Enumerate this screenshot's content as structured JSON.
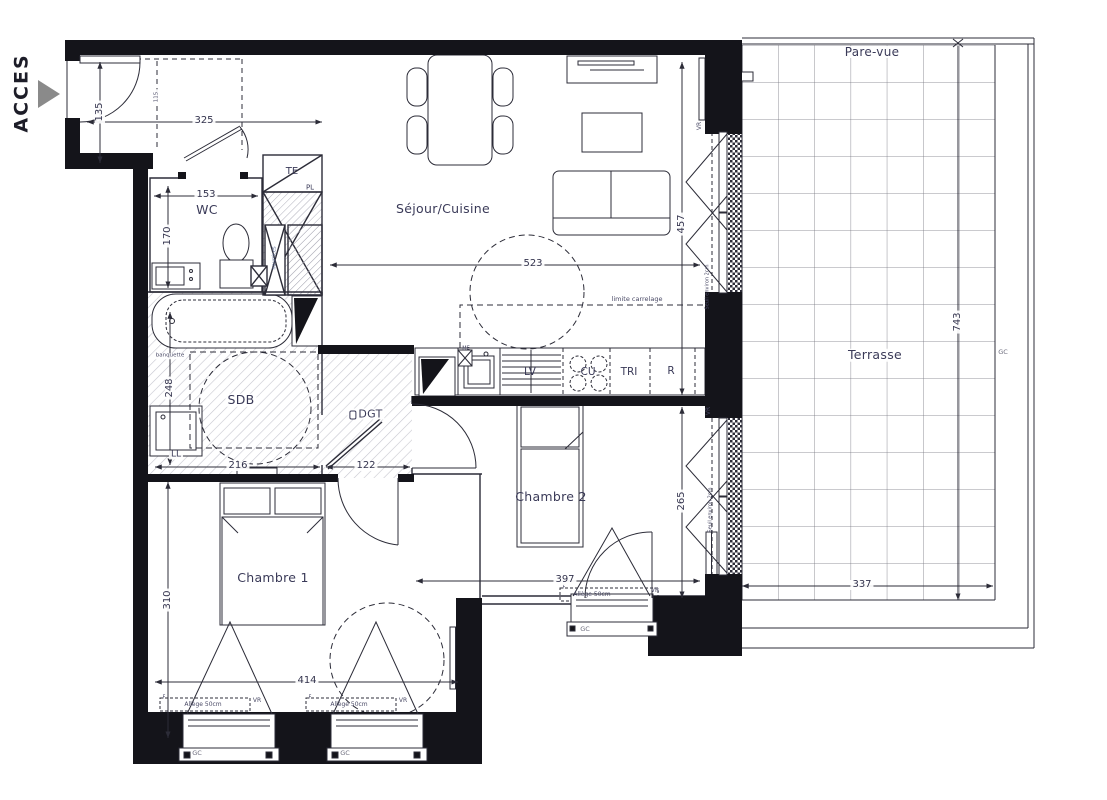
{
  "access": {
    "label": "ACCES"
  },
  "rooms": {
    "sejour": "Séjour/Cuisine",
    "wc": "WC",
    "sdb": "SDB",
    "dgt": "DGT",
    "chambre1": "Chambre 1",
    "chambre2": "Chambre 2",
    "terrasse": "Terrasse"
  },
  "storage": {
    "te": "TE",
    "pl": "PL"
  },
  "appliances": {
    "ll": "LL",
    "lv": "LV",
    "cu": "CU",
    "tri": "TRI",
    "r": "R",
    "me": "ME"
  },
  "notes": {
    "pare_vue": "Pare-vue",
    "limite_carrelage": "limite carrelage",
    "allege": "Allège 50cm",
    "vr": "VR",
    "gc": "GC",
    "f": "F",
    "seuil": "Seuil environ 2cm",
    "banquette": "banquette",
    "nourrices": "nourrices"
  },
  "dims": {
    "entry_w": "325",
    "entry_d": "135",
    "entry_inner": "115",
    "wc_w": "153",
    "wc_d": "170",
    "sejour_w": "523",
    "sejour_d": "457",
    "sdb_w": "216",
    "sdb_d": "248",
    "dgt_w": "122",
    "ch2_w": "397",
    "ch2_d": "265",
    "ch1_w": "414",
    "ch1_d": "310",
    "ter_d": "743",
    "ter_w": "337"
  },
  "colors": {
    "wall": "#14141a",
    "line": "#2c2c38",
    "text": "#3a3a58",
    "arrow_fill": "#8a8a8a"
  }
}
